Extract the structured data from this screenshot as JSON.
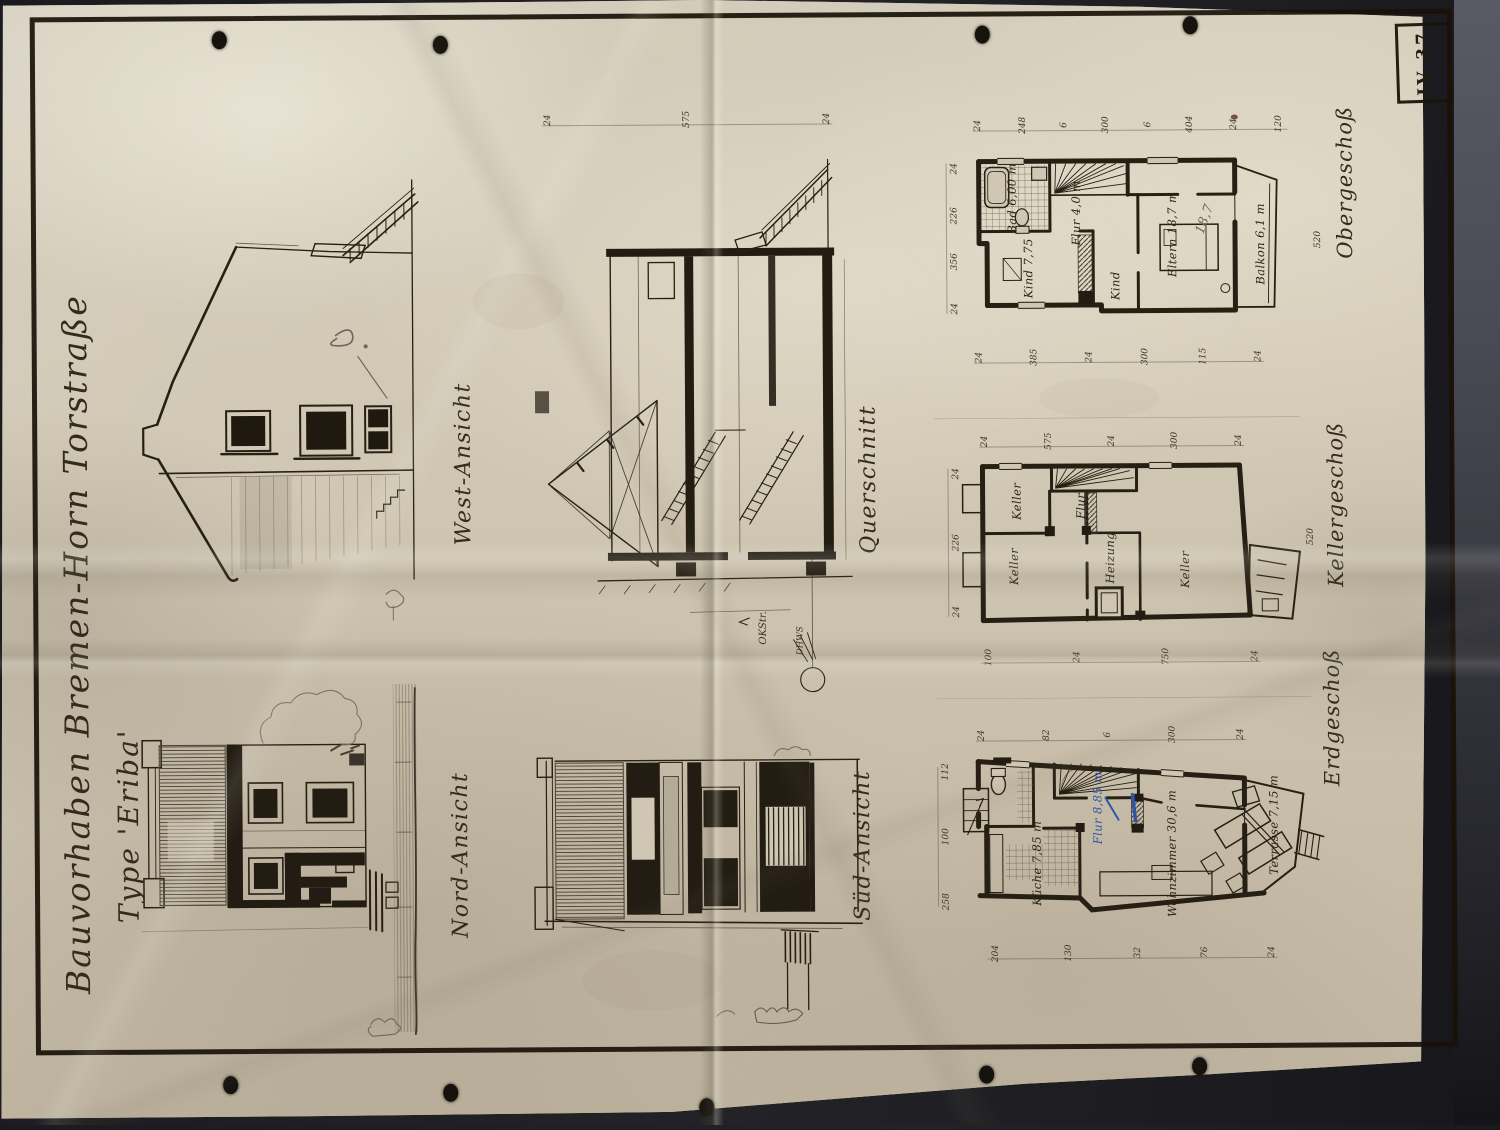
{
  "title": {
    "line1": "Bauvorhaben Bremen-Horn Torstraße",
    "line2": "Type 'Eriba'"
  },
  "sheet_number": "IV 37",
  "views": {
    "west": "West-Ansicht",
    "nord": "Nord-Ansicht",
    "querschnitt": "Querschnitt",
    "sued": "Süd-Ansicht"
  },
  "section": {
    "okstr": "OKStr.",
    "dhws": "DHWS",
    "dims_top": [
      "24",
      "575",
      "24"
    ]
  },
  "plans": {
    "og": {
      "label": "Obergeschoß",
      "rooms": {
        "bad": "Bad 6,00 m",
        "flur": "Flur 4,0 m",
        "kind1": "Kind 7,75",
        "kind2": "Kind",
        "eltern": "Eltern 18,7 m",
        "balkon": "Balkon 6,1 m"
      },
      "pencil_note": "18,7",
      "dim_side": "520",
      "dims_top": [
        "24",
        "248",
        "6",
        "300",
        "6",
        "404",
        "24",
        "120"
      ],
      "dims_bottom": [
        "24",
        "385",
        "24",
        "300",
        "115",
        "24"
      ],
      "dims_left": [
        "24",
        "226",
        "356",
        "24"
      ]
    },
    "kg": {
      "label": "Kellergeschoß",
      "rooms": {
        "keller1": "Keller",
        "keller2": "Keller",
        "flur": "Flur",
        "heizung": "Heizung",
        "keller3": "Keller"
      },
      "dim_side": "520",
      "dims_top": [
        "24",
        "575",
        "24",
        "300",
        "24"
      ],
      "dims_bottom": [
        "100",
        "24",
        "750",
        "24"
      ],
      "dims_left": [
        "24",
        "226",
        "24"
      ]
    },
    "eg": {
      "label": "Erdgeschoß",
      "rooms": {
        "kueche": "Küche 7,85 m",
        "flur": "Flur 8,85 m",
        "wohnzimmer": "Wohnzimmer 30,6 m",
        "terrasse": "Terrasse 7,15 m"
      },
      "dims_top": [
        "24",
        "82",
        "6",
        "300",
        "24"
      ],
      "dims_bottom": [
        "204",
        "130",
        "32",
        "76",
        "24"
      ],
      "dims_left": [
        "112",
        "100",
        "258"
      ]
    }
  },
  "colors": {
    "background": "#232327",
    "paper": "#cfc6b2",
    "ink": "#231d13",
    "pencil": "#6f6859",
    "blue_mark": "#2f55a8"
  }
}
